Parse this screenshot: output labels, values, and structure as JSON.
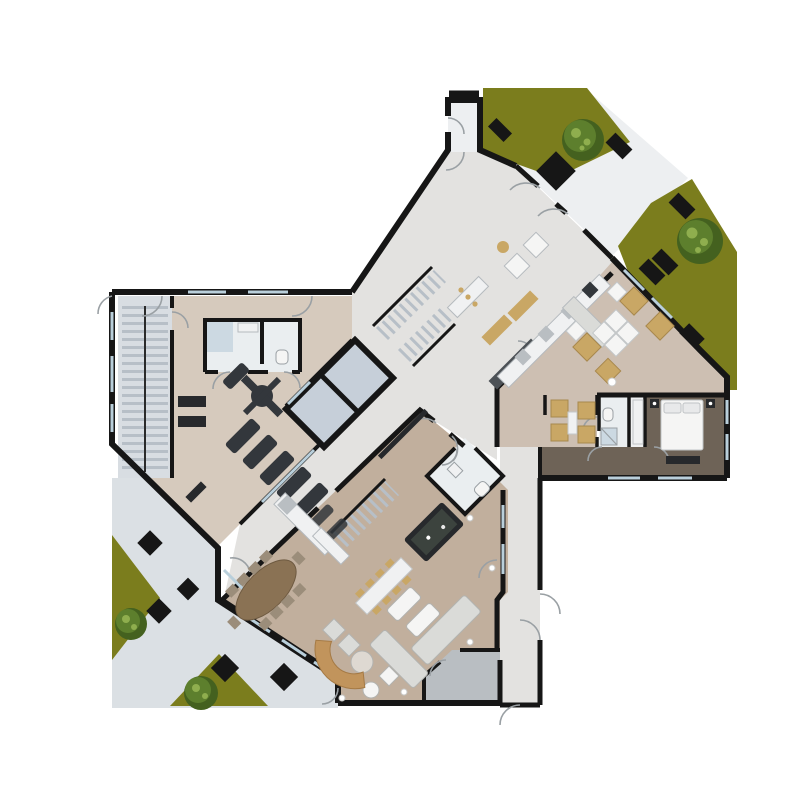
{
  "scene": {
    "kind": "architectural-floor-plan-render",
    "view": "top-down",
    "trees_count": 4,
    "elevator_cabins_count": 2,
    "treadmills_count": 5,
    "grass_patches_count": 4,
    "paver_diamonds_count": 5
  },
  "palette": {
    "bg": "#ffffff",
    "wall": "#161616",
    "wall_soft": "#2a2a2a",
    "paving": "#dbe0e4",
    "paving_light": "#edeff1",
    "grass": "#7b7d1d",
    "grass_dark": "#6e7018",
    "tree_dark": "#44611f",
    "tree_mid": "#5d7f2d",
    "tree_light": "#8fae4e",
    "floor_lobby": "#e3e2e0",
    "floor_gym": "#d6cabd",
    "floor_club": "#c1af9d",
    "floor_right": "#cdbfb2",
    "floor_wood_dark": "#6e6357",
    "tile": "#eaeef0",
    "tile_blue": "#ccd9e2",
    "elevator": "#c6cfd9",
    "stair": "#d8dde2",
    "stair_tread": "#b7bfc7",
    "counter_white": "#f0f1f2",
    "furn_white": "#f5f5f4",
    "furn_gray": "#b9bec2",
    "sofa_light": "#dadbd8",
    "furn_dark": "#27292c",
    "equip_dark": "#33373c",
    "tan": "#c9a765",
    "wood_bench": "#c1945c",
    "billiard": "#3c433e",
    "table_wood": "#8a7254",
    "window": "#b9cfdb",
    "door_arc": "#9aa0a4",
    "spot": "#f2f2f0",
    "planter_dark": "#4c5156"
  }
}
